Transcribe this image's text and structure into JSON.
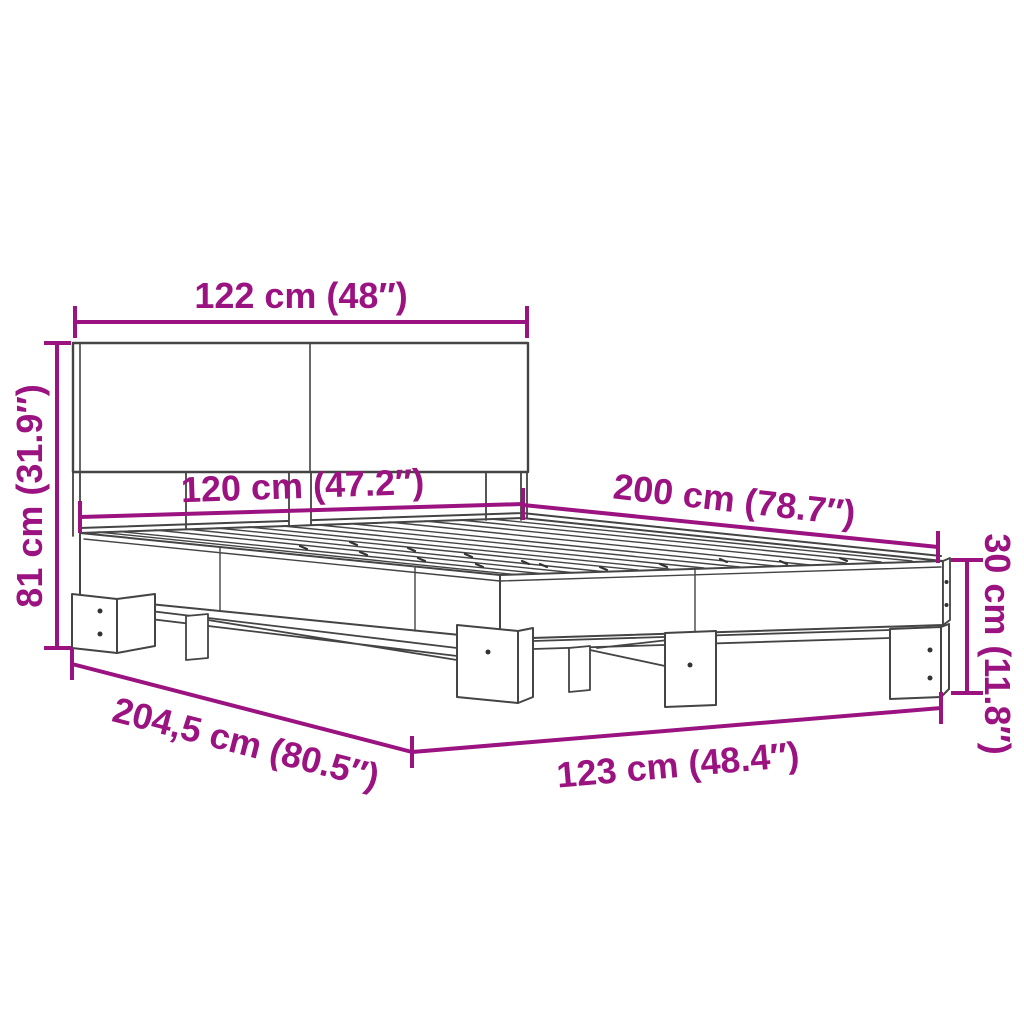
{
  "diagram": {
    "subject": "bed-frame-with-headboard-dimension-drawing",
    "style": {
      "dimension_color": "#9B1380",
      "outline_color": "#444444",
      "background": "#ffffff"
    },
    "dimensions": [
      {
        "id": "headboard-width",
        "label": "122 cm (48″)"
      },
      {
        "id": "total-height",
        "label": "81 cm (31.9″)"
      },
      {
        "id": "bed-width-inner",
        "label": "120 cm (47.2″)"
      },
      {
        "id": "bed-length",
        "label": "200 cm (78.7″)"
      },
      {
        "id": "frame-height",
        "label": "30 cm (11.8″)"
      },
      {
        "id": "diagonal-length",
        "label": "204,5 cm (80.5″)"
      },
      {
        "id": "bed-width-outer",
        "label": "123 cm (48.4″)"
      }
    ]
  }
}
